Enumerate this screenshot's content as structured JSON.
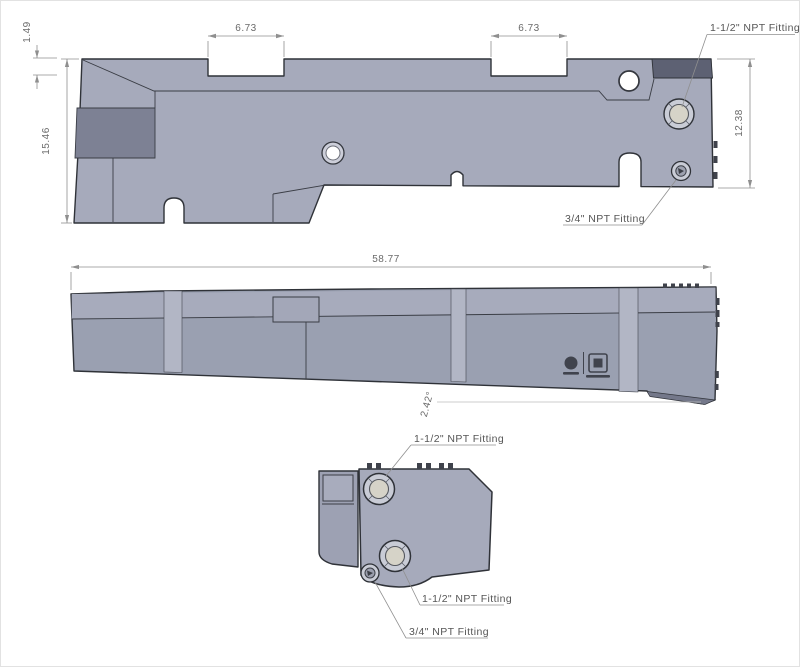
{
  "drawing": {
    "type": "cad-multiview-part-drawing",
    "part": "tank with NPT fittings"
  },
  "top_view": {
    "dim_notch1": "6.73",
    "dim_notch2": "6.73",
    "dim_lip": "1.49",
    "dim_height": "15.46",
    "dim_right_height": "12.38",
    "label_fitting_large": "1-1/2\" NPT Fitting",
    "label_fitting_small": "3/4\" NPT Fitting"
  },
  "side_view": {
    "dim_length": "58.77",
    "dim_angle": "2.42°"
  },
  "end_view": {
    "label_fitting_top": "1-1/2\" NPT Fitting",
    "label_fitting_bottom": "1-1/2\" NPT Fitting",
    "label_fitting_drain": "3/4\" NPT Fitting"
  },
  "icons": {
    "round_logo": "certification-round-mark",
    "square_logo": "certification-square-mark"
  },
  "colors": {
    "body_top_face": "#a6aabb",
    "body_side_face": "#9aa0b1",
    "body_dark_panel": "#7d8194",
    "corner_band_dark": "#5d6173",
    "seam_light": "#b2b6c5",
    "fitting_ring": "#c9ccd6",
    "fitting_inner": "#d6d3c8",
    "outline": "#2f3238",
    "dim_gray": "#8f8f8f"
  }
}
